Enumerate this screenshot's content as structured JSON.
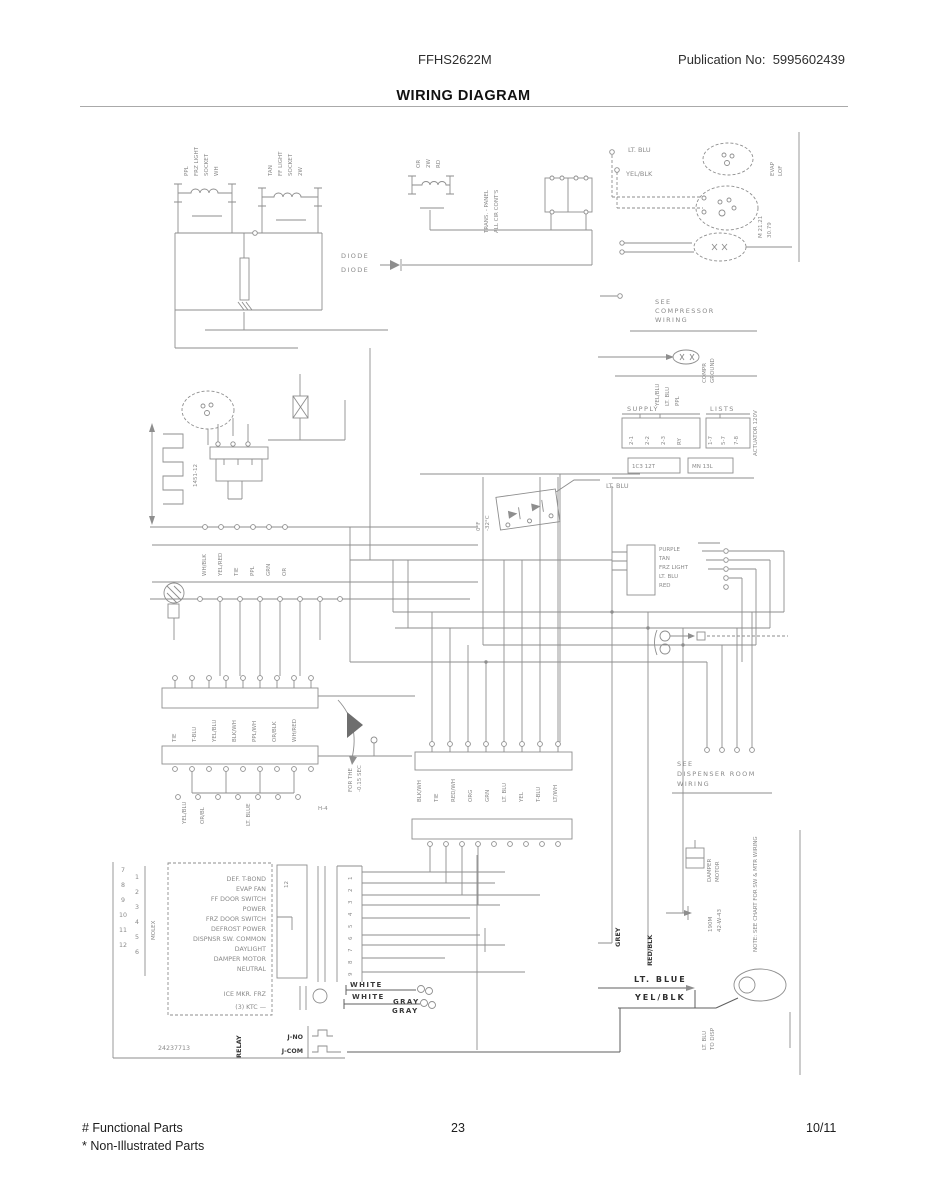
{
  "page": {
    "model": "FFHS2622M",
    "publication": "Publication No:  5995602439",
    "title": "WIRING DIAGRAM",
    "footer": {
      "functional": "# Functional Parts",
      "non_illustrated": "* Non-Illustrated Parts",
      "page_number": "23",
      "date": "10/11"
    }
  },
  "diagram": {
    "labels": {
      "c1a": "PPL",
      "c1b": "FRZ LIGHT",
      "c1c": "SOCKET",
      "c1d": "WH",
      "c2a": "TAN",
      "c2b": "FF LIGHT",
      "c2c": "SOCKET",
      "c2d": "2W",
      "c3a": "OR",
      "c3b": "2W",
      "c3c": "RD",
      "panel1": "TRANS. - PANEL",
      "panel2": "ALL CIR CONT'S",
      "ltblu_dash": "LT. BLU",
      "yelblk_dash": "YEL/BLK",
      "fan1a": "EVAP",
      "fan1b": "LOF",
      "fan2a": "M 21.21",
      "fan2b": "30.79",
      "see_comp1": "SEE",
      "see_comp2": "COMPRESSOR",
      "see_comp3": "WIRING",
      "comp_gnd1": "COMPR",
      "comp_gnd2": "GROUND",
      "supply": "SUPPLY",
      "lists": "LISTS",
      "supv1": "YEL/BLU",
      "supv2": "LT. BLU",
      "supv3": "PPL",
      "b1a": "2-1",
      "b1b": "2-2",
      "b1c": "2-3",
      "b1d": "RY",
      "b2a": "1-7",
      "b2b": "5-7",
      "b2c": "7-8",
      "actuator": "ACTUATOR 120V",
      "b3": "1C3 12T",
      "b4": "MN 13L",
      "diode1": "DIODE",
      "diode2": "DIODE",
      "low1": "0°F",
      "low2": "-32°C",
      "ltblu_mid": "LT. BLU",
      "heater": "1451-12",
      "r1b1": "YEL/BLU",
      "r1b2": "OR/BL",
      "lblue_v": "LT. BLUE",
      "h4": "H-4",
      "delay1": "FOR THE",
      "delay2": "-0.15 SEC",
      "see_disp1": "SEE",
      "see_disp2": "DISPENSER ROOM",
      "see_disp3": "WIRING",
      "damper1": "DAMPER",
      "damper2": "MOTOR",
      "code1": "190M",
      "code2": "42-W-43",
      "note": "NOTE: SEE CHART FOR SW & MTR WIRING",
      "grey": "GREY",
      "redblk": "RED/BLK",
      "ltblue": "LT. BLUE",
      "yelblk": "YEL/BLK",
      "white1": "WHITE",
      "white2": "WHITE",
      "gray1": "GRAY",
      "gray2": "GRAY",
      "jno": "J-NO",
      "jcom": "J-COM",
      "relay": "RELAY",
      "dispv1": "LT. BLU",
      "dispv2": "TO DISP",
      "part": "24237713",
      "tallrect": "12",
      "molex": "MOLEX",
      "ice1": "ICE MKR. FRZ",
      "ice2": "(3) KTC —"
    },
    "rows": {
      "r0": [
        "WH/BLK",
        "YEL/RED",
        "TIE",
        "PPL",
        "GRN",
        "OR"
      ],
      "r1": [
        "TIE",
        "T-BLU",
        "YEL/BLU",
        "BLK/WH",
        "PPL/WH",
        "OR/BLK",
        "WH/RED"
      ],
      "r2": [
        "BLK/WH",
        "TIE",
        "RED/WH",
        "ORG",
        "GRN",
        "LT. BLU",
        "YEL",
        "T-BLU",
        "LT/WH"
      ]
    },
    "control_box": [
      "PURPLE",
      "TAN",
      "FRZ LIGHT",
      "LT. BLU",
      "RED"
    ],
    "relay_box": [
      "DEF. T-BOND",
      "EVAP FAN",
      "FF DOOR SWITCH",
      "POWER",
      "FRZ DOOR SWITCH",
      "DEFROST POWER",
      "DISPNSR SW. COMMON",
      "DAYLIGHT",
      "DAMPER MOTOR",
      "NEUTRAL"
    ],
    "pins_left": [
      "7",
      "8",
      "9",
      "10",
      "11",
      "12"
    ],
    "pins_right": [
      "1",
      "2",
      "3",
      "4",
      "5",
      "6"
    ],
    "strip": [
      "1",
      "2",
      "3",
      "4",
      "5",
      "6",
      "7",
      "8",
      "9"
    ]
  }
}
